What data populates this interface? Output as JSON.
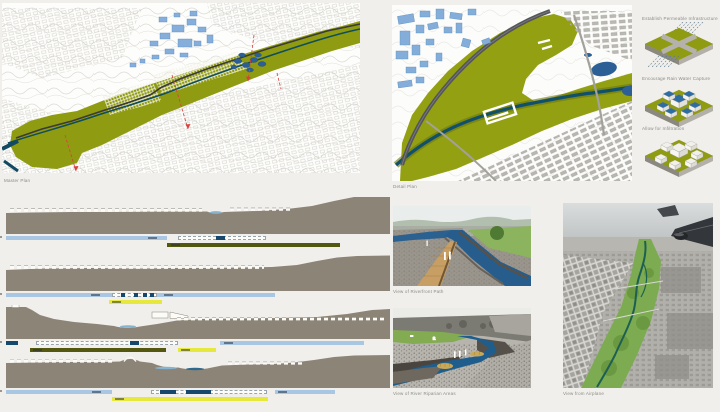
{
  "page": {
    "background": "#f0efeb"
  },
  "master_plan": {
    "caption": "Master Plan"
  },
  "detail_plan": {
    "caption": "Detail Plan"
  },
  "strategy_diagrams": {
    "items": [
      {
        "label": "Establish Permeable Infrastructure"
      },
      {
        "label": "Encourage Rain Water Capture"
      },
      {
        "label": "Allow for Infiltration"
      }
    ]
  },
  "sections": {
    "colors": {
      "lightblue": "#a9c6e2",
      "olive": "#54570f",
      "yellow": "#e6e83e",
      "navy": "#16486e",
      "dashed_border": "#9aa4ae"
    },
    "items": [
      {
        "bars": [
          {
            "row": 0,
            "color": "lightblue",
            "x": 4,
            "w": 161,
            "marks": [
              142
            ]
          },
          {
            "row": 0,
            "type": "dashed",
            "x": 176,
            "w": 88,
            "segs": [
              [
                37,
                9
              ]
            ]
          },
          {
            "row": 1,
            "color": "olive",
            "x": 165,
            "w": 173,
            "marks": [
              4
            ]
          }
        ]
      },
      {
        "bars": [
          {
            "row": 0,
            "color": "lightblue",
            "x": 4,
            "w": 269,
            "marks": [
              85,
              158
            ]
          },
          {
            "row": 0,
            "type": "dashed",
            "x": 110,
            "w": 45,
            "segs": [
              [
                8,
                4
              ],
              [
                21,
                4
              ],
              [
                30,
                4
              ],
              [
                37,
                4
              ]
            ]
          },
          {
            "row": 1,
            "color": "yellow",
            "x": 107,
            "w": 53,
            "marks": [
              3
            ]
          }
        ]
      },
      {
        "bars": [
          {
            "row": 0,
            "color": "navy",
            "x": 4,
            "w": 12
          },
          {
            "row": 0,
            "type": "dashed",
            "x": 34,
            "w": 142,
            "segs": [
              [
                93,
                9
              ]
            ]
          },
          {
            "row": 0,
            "color": "lightblue",
            "x": 218,
            "w": 144,
            "marks": [
              4
            ]
          },
          {
            "row": 1,
            "color": "olive",
            "x": 28,
            "w": 136,
            "marks": [
              3
            ]
          },
          {
            "row": 1,
            "color": "yellow",
            "x": 176,
            "w": 38,
            "marks": [
              3
            ]
          }
        ]
      },
      {
        "bars": [
          {
            "row": 0,
            "color": "lightblue",
            "x": 4,
            "w": 106,
            "marks": [
              86
            ]
          },
          {
            "row": 0,
            "type": "dashed",
            "x": 149,
            "w": 116,
            "segs": [
              [
                8,
                16
              ],
              [
                34,
                25
              ]
            ]
          },
          {
            "row": 0,
            "color": "lightblue",
            "x": 273,
            "w": 60,
            "marks": [
              3
            ]
          },
          {
            "row": 1,
            "color": "yellow",
            "x": 110,
            "w": 156,
            "marks": [
              3
            ]
          }
        ]
      }
    ]
  },
  "views": {
    "riverside": {
      "caption": "View of Riverfront Path"
    },
    "riparian": {
      "caption": "View of River Riparian Areas"
    },
    "airplane": {
      "caption": "View from Airplane"
    }
  }
}
